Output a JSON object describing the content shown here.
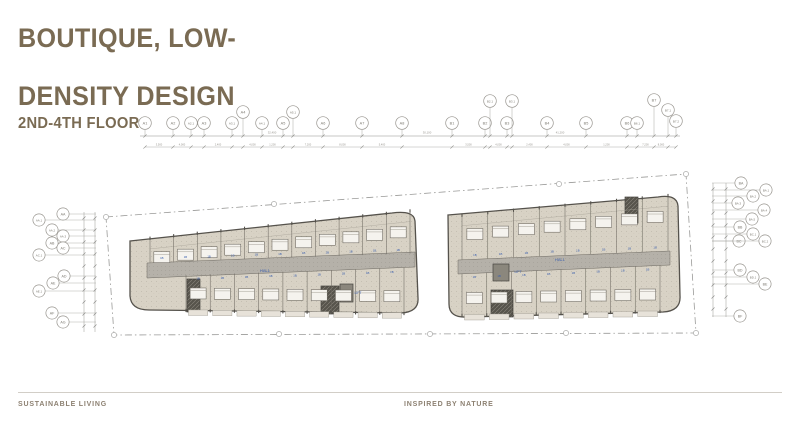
{
  "title_line1": "BOUTIQUE, LOW-",
  "title_line2": "DENSITY DESIGN",
  "subtitle": "2ND-4TH FLOOR",
  "footer": {
    "left": "SUSTAINABLE LIVING",
    "center": "INSPIRED BY NATURE"
  },
  "colors": {
    "accent": "#7a6b53",
    "plan_blue": "#3a5fae",
    "floor": "#d8d2c5",
    "corridor": "#b5b1a9"
  },
  "plan": {
    "hall_label": "HALL",
    "lift_label": "LIFT",
    "unit_label": "1B",
    "dim_totals": [
      {
        "text": "32,400",
        "x": 272
      },
      {
        "text": "30,100",
        "x": 427
      },
      {
        "text": "41,200",
        "x": 560
      }
    ],
    "seg_dims": [
      "3,500",
      "4,000",
      "2,400",
      "4,000",
      "1,200",
      "7,200",
      "8,000",
      "5,400",
      "4,050",
      "2,250"
    ],
    "grid_top_a": [
      {
        "label": "A1",
        "x": 145
      },
      {
        "label": "A2",
        "x": 173
      },
      {
        "label": "A2.1",
        "x": 191
      },
      {
        "label": "A3",
        "x": 204
      },
      {
        "label": "A3.1",
        "x": 232
      },
      {
        "label": "A4",
        "x": 243,
        "y": 112
      },
      {
        "label": "A4.1",
        "x": 262
      },
      {
        "label": "A5",
        "x": 283
      },
      {
        "label": "A5.1",
        "x": 293,
        "y": 112
      },
      {
        "label": "A6",
        "x": 323
      },
      {
        "label": "A7",
        "x": 362
      },
      {
        "label": "A8",
        "x": 402
      }
    ],
    "grid_top_b": [
      {
        "label": "B1",
        "x": 452
      },
      {
        "label": "B2",
        "x": 485
      },
      {
        "label": "B2.1",
        "x": 490,
        "y": 101
      },
      {
        "label": "B3",
        "x": 507
      },
      {
        "label": "B3.1",
        "x": 512,
        "y": 101
      },
      {
        "label": "B4",
        "x": 547
      },
      {
        "label": "B5",
        "x": 586
      },
      {
        "label": "B6",
        "x": 627
      },
      {
        "label": "B6.1",
        "x": 637
      },
      {
        "label": "B7",
        "x": 654,
        "y": 100
      },
      {
        "label": "B7.1",
        "x": 668,
        "y": 110
      },
      {
        "label": "B7.2",
        "x": 676,
        "y": 121
      }
    ],
    "grid_left": [
      {
        "label": "AA",
        "x": 63,
        "y": 214
      },
      {
        "label": "AA.1",
        "x": 39,
        "y": 220
      },
      {
        "label": "AA.2",
        "x": 52,
        "y": 230
      },
      {
        "label": "AA.3",
        "x": 63,
        "y": 236
      },
      {
        "label": "AB",
        "x": 52,
        "y": 243
      },
      {
        "label": "AC",
        "x": 63,
        "y": 248
      },
      {
        "label": "AC.1",
        "x": 39,
        "y": 255
      },
      {
        "label": "AD",
        "x": 64,
        "y": 276
      },
      {
        "label": "AE",
        "x": 53,
        "y": 283
      },
      {
        "label": "AE.1",
        "x": 39,
        "y": 291
      },
      {
        "label": "AF",
        "x": 52,
        "y": 313
      },
      {
        "label": "AG",
        "x": 63,
        "y": 322
      }
    ],
    "grid_right": [
      {
        "label": "BA",
        "x": 741,
        "y": 183
      },
      {
        "label": "BA.1",
        "x": 766,
        "y": 190
      },
      {
        "label": "BA.2",
        "x": 753,
        "y": 196
      },
      {
        "label": "BA.3",
        "x": 738,
        "y": 203
      },
      {
        "label": "BA.4",
        "x": 764,
        "y": 210
      },
      {
        "label": "BA.5",
        "x": 752,
        "y": 219
      },
      {
        "label": "BB",
        "x": 740,
        "y": 227
      },
      {
        "label": "BC.1",
        "x": 753,
        "y": 234
      },
      {
        "label": "BC",
        "x": 739,
        "y": 241
      },
      {
        "label": "BC.2",
        "x": 765,
        "y": 241
      },
      {
        "label": "BD",
        "x": 740,
        "y": 270
      },
      {
        "label": "BD.1",
        "x": 753,
        "y": 277
      },
      {
        "label": "BE",
        "x": 765,
        "y": 284
      },
      {
        "label": "BF",
        "x": 740,
        "y": 316
      }
    ]
  }
}
